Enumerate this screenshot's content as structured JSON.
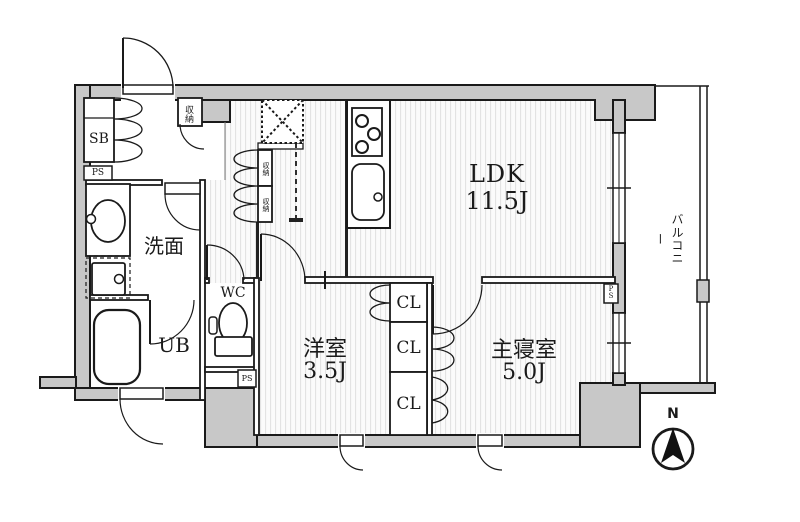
{
  "rooms": {
    "ldk": {
      "name": "LDK",
      "area": "11.5J"
    },
    "youshitsu": {
      "name": "洋室",
      "area": "3.5J"
    },
    "shushinshitsu": {
      "name": "主寝室",
      "area": "5.0J"
    },
    "senmen": {
      "name": "洗面"
    },
    "wc": {
      "name": "WC"
    },
    "ub": {
      "name": "UB"
    },
    "sb": {
      "name": "SB"
    },
    "balcony": {
      "name": "バルコニー"
    }
  },
  "closets": {
    "cl1": "CL",
    "cl2": "CL",
    "cl3": "CL"
  },
  "storage": {
    "genkan": "収納",
    "hall1": "収納",
    "hall2": "収納"
  },
  "pipe_spaces": {
    "ps1": "PS",
    "ps2": "PS",
    "ps3": "PS"
  },
  "compass": {
    "north": "N"
  },
  "colors": {
    "wall_fill": "#c8c8c8",
    "line": "#1a1a1a",
    "floor_stripe": "#e3e3e3"
  }
}
